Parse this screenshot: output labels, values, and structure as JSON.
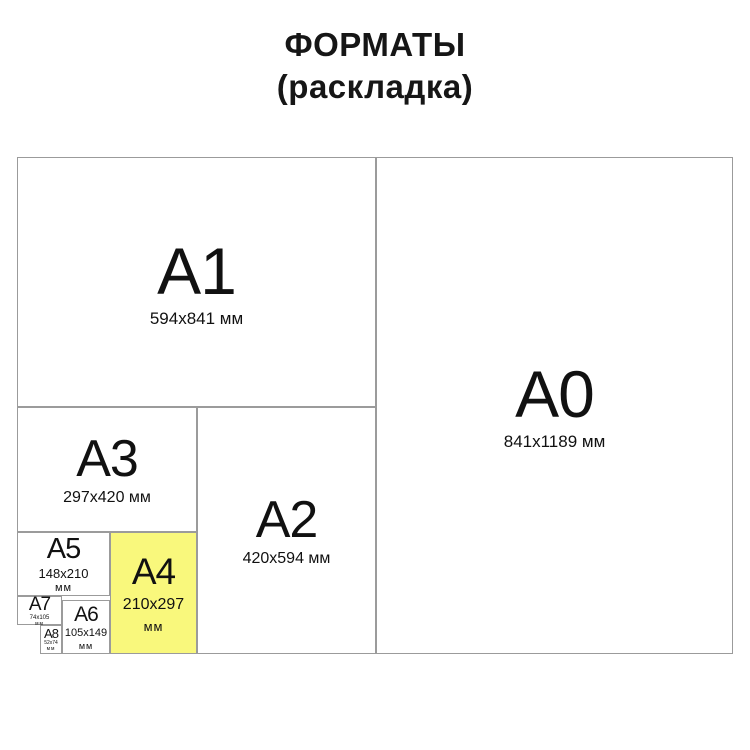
{
  "page_title": {
    "line1": "ФОРМАТЫ",
    "line2": "(раскладка)"
  },
  "colors": {
    "background": "#FFFFFF",
    "line": "#9B9B9B",
    "text": "#111111",
    "highlight_fill": "#F9F87C"
  },
  "formats": [
    {
      "id": "A0",
      "label": "A0",
      "size": "841x1189 мм"
    },
    {
      "id": "A1",
      "label": "A1",
      "size": "594x841 мм"
    },
    {
      "id": "A2",
      "label": "A2",
      "size": "420x594 мм"
    },
    {
      "id": "A3",
      "label": "A3",
      "size": "297x420 мм"
    },
    {
      "id": "A4",
      "label": "A4",
      "size": "210x297",
      "unit": "мм",
      "highlighted": true
    },
    {
      "id": "A5",
      "label": "A5",
      "size": "148x210",
      "unit": "мм"
    },
    {
      "id": "A6",
      "label": "A6",
      "size": "105x149",
      "unit": "мм"
    },
    {
      "id": "A7",
      "label": "A7",
      "size": "74x105",
      "unit": "мм"
    },
    {
      "id": "A8",
      "label": "A8",
      "size": "52x74",
      "unit": "мм"
    }
  ]
}
